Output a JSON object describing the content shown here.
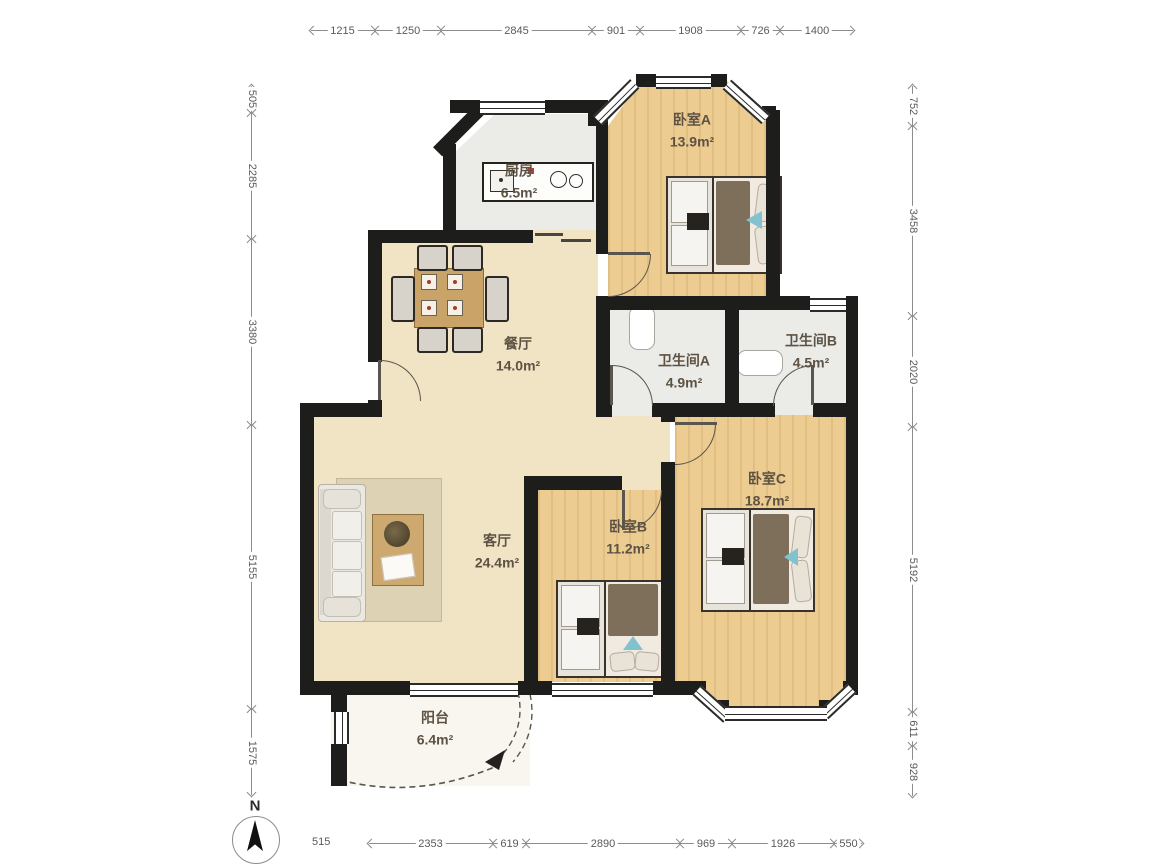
{
  "plan": {
    "compass_label": "N",
    "rooms": {
      "bedroomA": {
        "name": "卧室A",
        "area": "13.9m²"
      },
      "kitchen": {
        "name": "厨房",
        "area": "6.5m²"
      },
      "dining": {
        "name": "餐厅",
        "area": "14.0m²"
      },
      "bathA": {
        "name": "卫生间A",
        "area": "4.9m²"
      },
      "bathB": {
        "name": "卫生间B",
        "area": "4.5m²"
      },
      "living": {
        "name": "客厅",
        "area": "24.4m²"
      },
      "bedroomB": {
        "name": "卧室B",
        "area": "11.2m²"
      },
      "bedroomC": {
        "name": "卧室C",
        "area": "18.7m²"
      },
      "balcony": {
        "name": "阳台",
        "area": "6.4m²"
      }
    },
    "dimensions": {
      "top": [
        "1215",
        "1250",
        "2845",
        "901",
        "1908",
        "726",
        "1400"
      ],
      "left": [
        "505",
        "2285",
        "3380",
        "5155",
        "1575"
      ],
      "right": [
        "752",
        "3458",
        "2020",
        "5192",
        "611",
        "928"
      ],
      "bottom_offset": "515",
      "bottom": [
        "2353",
        "619",
        "2890",
        "969",
        "1926",
        "550"
      ]
    },
    "colors": {
      "wall": "#1d1d1b",
      "wood_floor": "#eccc90",
      "cream_floor": "#f0e4c5",
      "tile_floor": "#ebebe7",
      "balcony_floor": "#f8f6ef",
      "accent_teal": "#82c2cf"
    }
  }
}
